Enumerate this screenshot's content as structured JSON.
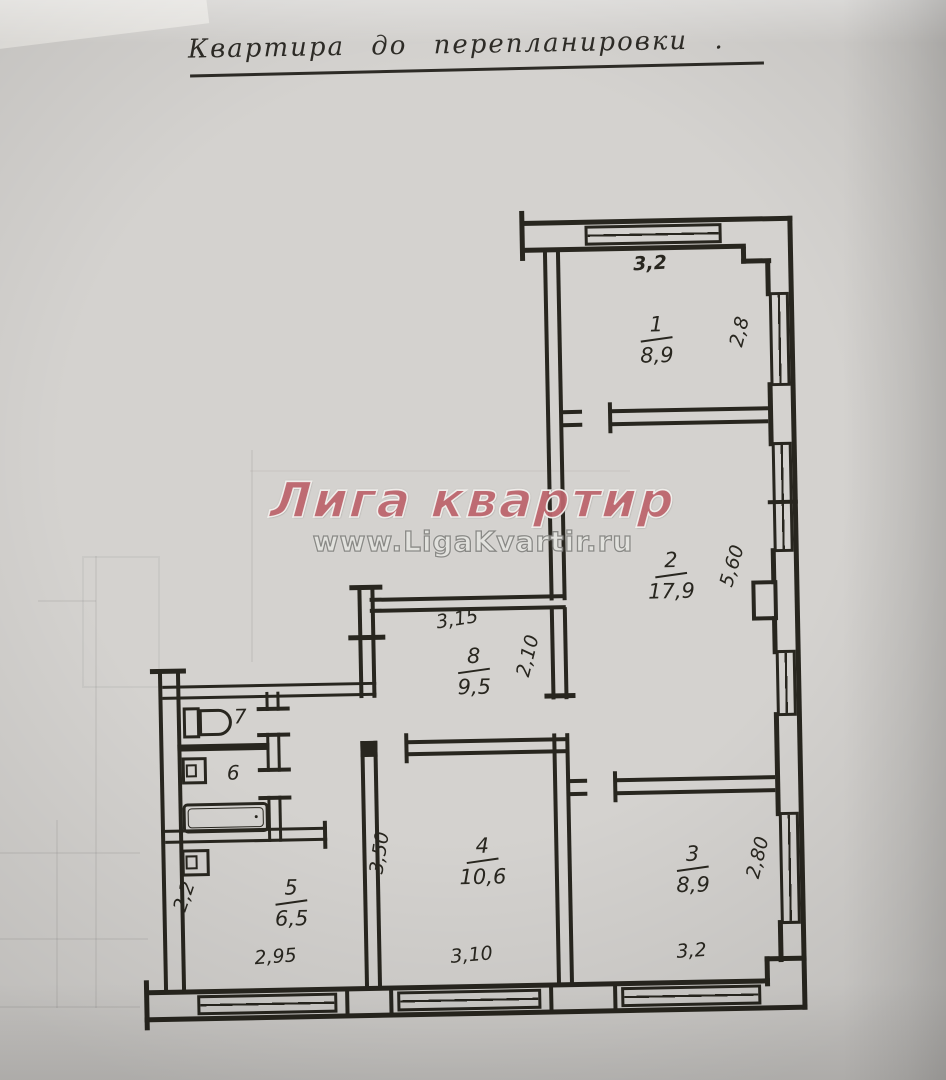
{
  "title": {
    "text": "Квартира до перепланировки ."
  },
  "watermark": {
    "line1": "Лига квартир",
    "line2": "www.LigaKvartir.ru",
    "accent_color": "#c4666f",
    "url_color": "#8f8f8d"
  },
  "plan": {
    "drawing_type": "floor-plan-before-renovation",
    "ink_color": "#28261f",
    "paper_color": "#d4d2cf",
    "rooms": [
      {
        "number": "1",
        "area": "8,9",
        "dims": {
          "top": "3,2",
          "right": "2,8"
        }
      },
      {
        "number": "2",
        "area": "17,9",
        "dims": {
          "right": "5,60"
        }
      },
      {
        "number": "3",
        "area": "8,9",
        "dims": {
          "right": "2,80",
          "bottom": "3,2"
        }
      },
      {
        "number": "4",
        "area": "10,6",
        "dims": {
          "left": "3,50",
          "bottom": "3,10"
        }
      },
      {
        "number": "5",
        "area": "6,5",
        "dims": {
          "left": "2,2",
          "bottom": "2,95"
        }
      },
      {
        "number": "6"
      },
      {
        "number": "7"
      },
      {
        "number": "8",
        "area": "9,5",
        "dims": {
          "top": "3,15",
          "right": "2,10"
        }
      }
    ],
    "fixtures": [
      "toilet",
      "sink",
      "bathtub",
      "washbasin"
    ]
  }
}
